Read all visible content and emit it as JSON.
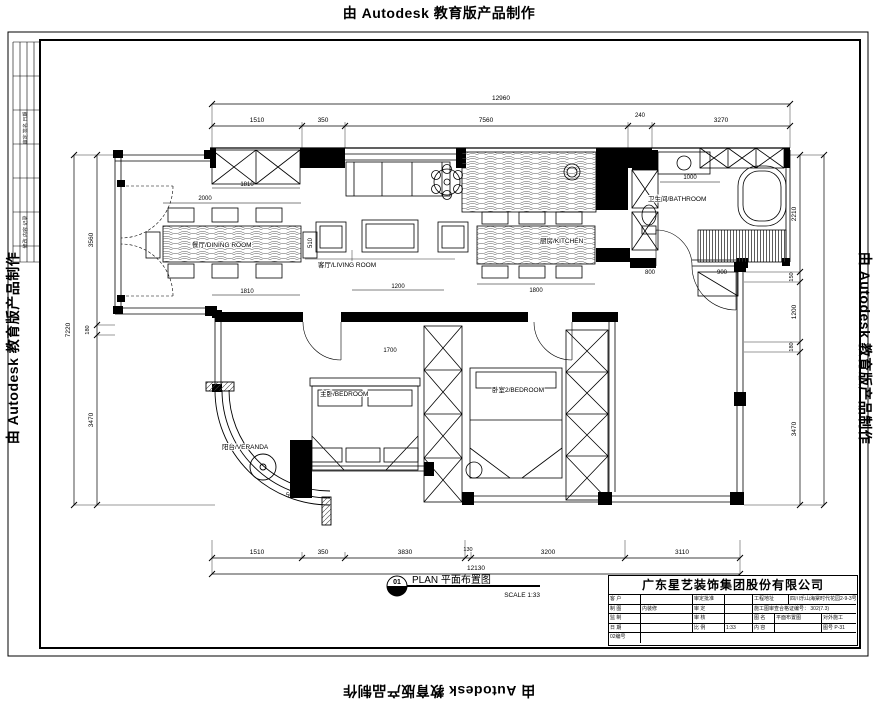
{
  "stamps": {
    "text": "由 Autodesk 教育版产品制作"
  },
  "plan_title": {
    "number": "01",
    "label": "PLAN 平面布置图",
    "scale": "SCALE 1:33"
  },
  "rooms": {
    "living": "客厅/LIVING ROOM",
    "dining": "餐厅/DINING ROOM",
    "kitchen": "厨房/KITCHEN",
    "bathroom": "卫生间/BATHROOM",
    "bedroom1": "主卧/BEDROOM",
    "bedroom2": "卧室2/BEDROOM",
    "veranda": "阳台/VERANDA"
  },
  "dims": {
    "top_total": "12960",
    "top_segments": [
      "1510",
      "350",
      "7560",
      "240",
      "3270"
    ],
    "bottom_total": "12130",
    "bottom_segments": [
      "1510",
      "350",
      "3830",
      "130",
      "3200",
      "3110"
    ],
    "left_total": "7220",
    "left_segments": [
      "3560",
      "180",
      "3470"
    ],
    "right_total": "7220",
    "right_segments": [
      "2210",
      "150",
      "1200",
      "180",
      "3470"
    ],
    "interior": {
      "cabinet": "1810",
      "dining_w": "2000",
      "dining_d": "510",
      "dining_b": "1810",
      "sofa": "1200",
      "bed1": "1700",
      "island": "1800",
      "bath": "1000",
      "hall_a": "800",
      "hall_b": "900",
      "veranda": "500"
    }
  },
  "title_block": {
    "company": "广东星艺装饰集团股份有限公司",
    "r1c1": "客 户",
    "r1c3": "审定批准",
    "r1c5": "工程地址",
    "r1c6": "四川乐山海棠时代花园2-9-3号",
    "r2c1": "制 图",
    "r2c2": "内装修",
    "r2c3": "审 定",
    "r2c5": "施工图审查合格证编号： 302(7.3)",
    "r3c1": "监 制",
    "r3c3": "审 核",
    "r3c5": "图 名",
    "r3c6": "平面布置图",
    "r3c7": "对外施工",
    "r4c1": "日 期",
    "r4c3": "比 例",
    "r4c4": "1:33",
    "r4c5": "内 容",
    "r4c7": "图号 P-31",
    "r5c1": "02编号"
  },
  "left_strip": {
    "note1": "审定 签名 日期",
    "note2": "修改 内容 记录"
  }
}
